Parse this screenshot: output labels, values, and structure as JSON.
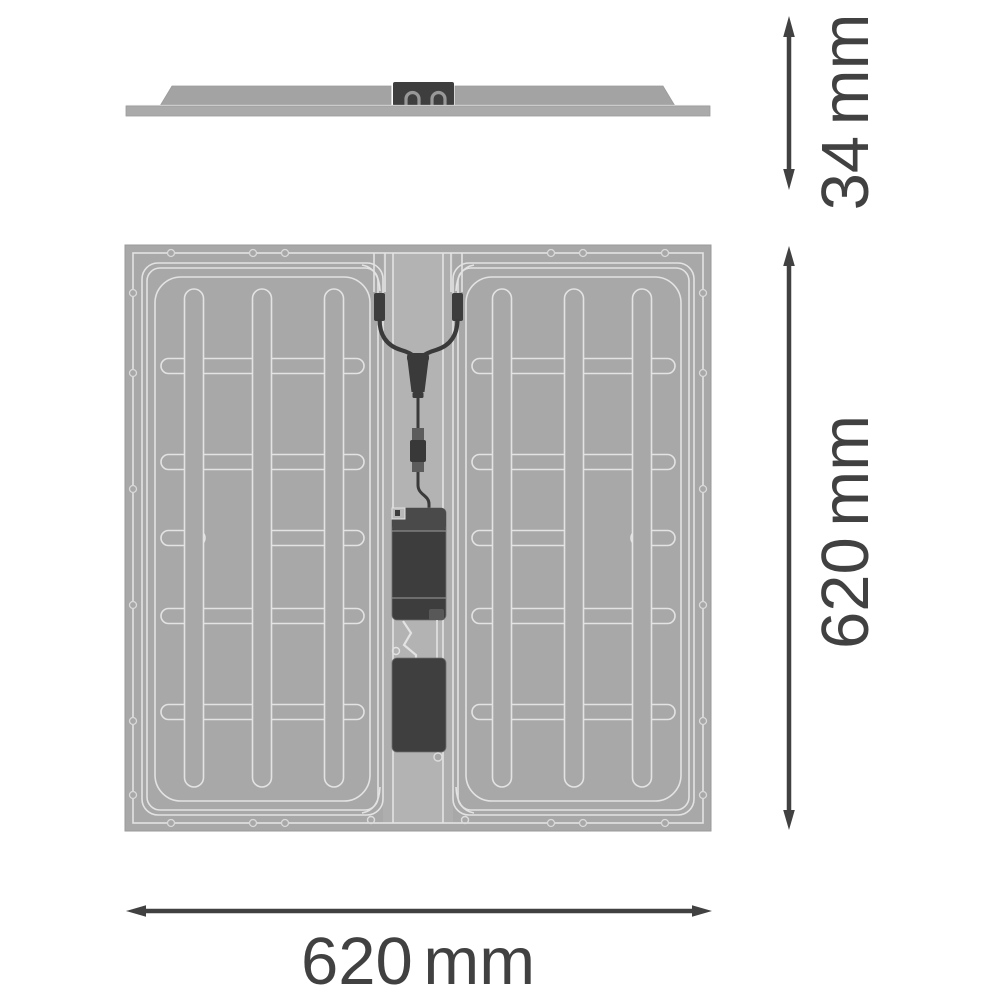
{
  "drawing": {
    "title": "LED panel luminaire dimension drawing",
    "views": {
      "side": {
        "name": "side-profile-view"
      },
      "rear": {
        "name": "rear-view"
      }
    },
    "dimensions": {
      "height": {
        "value": 34,
        "unit": "mm",
        "label": "34 mm",
        "orientation": "vertical"
      },
      "panel_height": {
        "value": 620,
        "unit": "mm",
        "label": "620 mm",
        "orientation": "vertical"
      },
      "panel_width": {
        "value": 620,
        "unit": "mm",
        "label": "620 mm",
        "orientation": "horizontal"
      }
    },
    "colors": {
      "background": "#ffffff",
      "panel_gray": "#a8a8a8",
      "channel_gray": "#aeaeae",
      "outline_light": "#e3e3e3",
      "component_dark": "#3d3d3d",
      "dimension_ink": "#414141"
    }
  }
}
